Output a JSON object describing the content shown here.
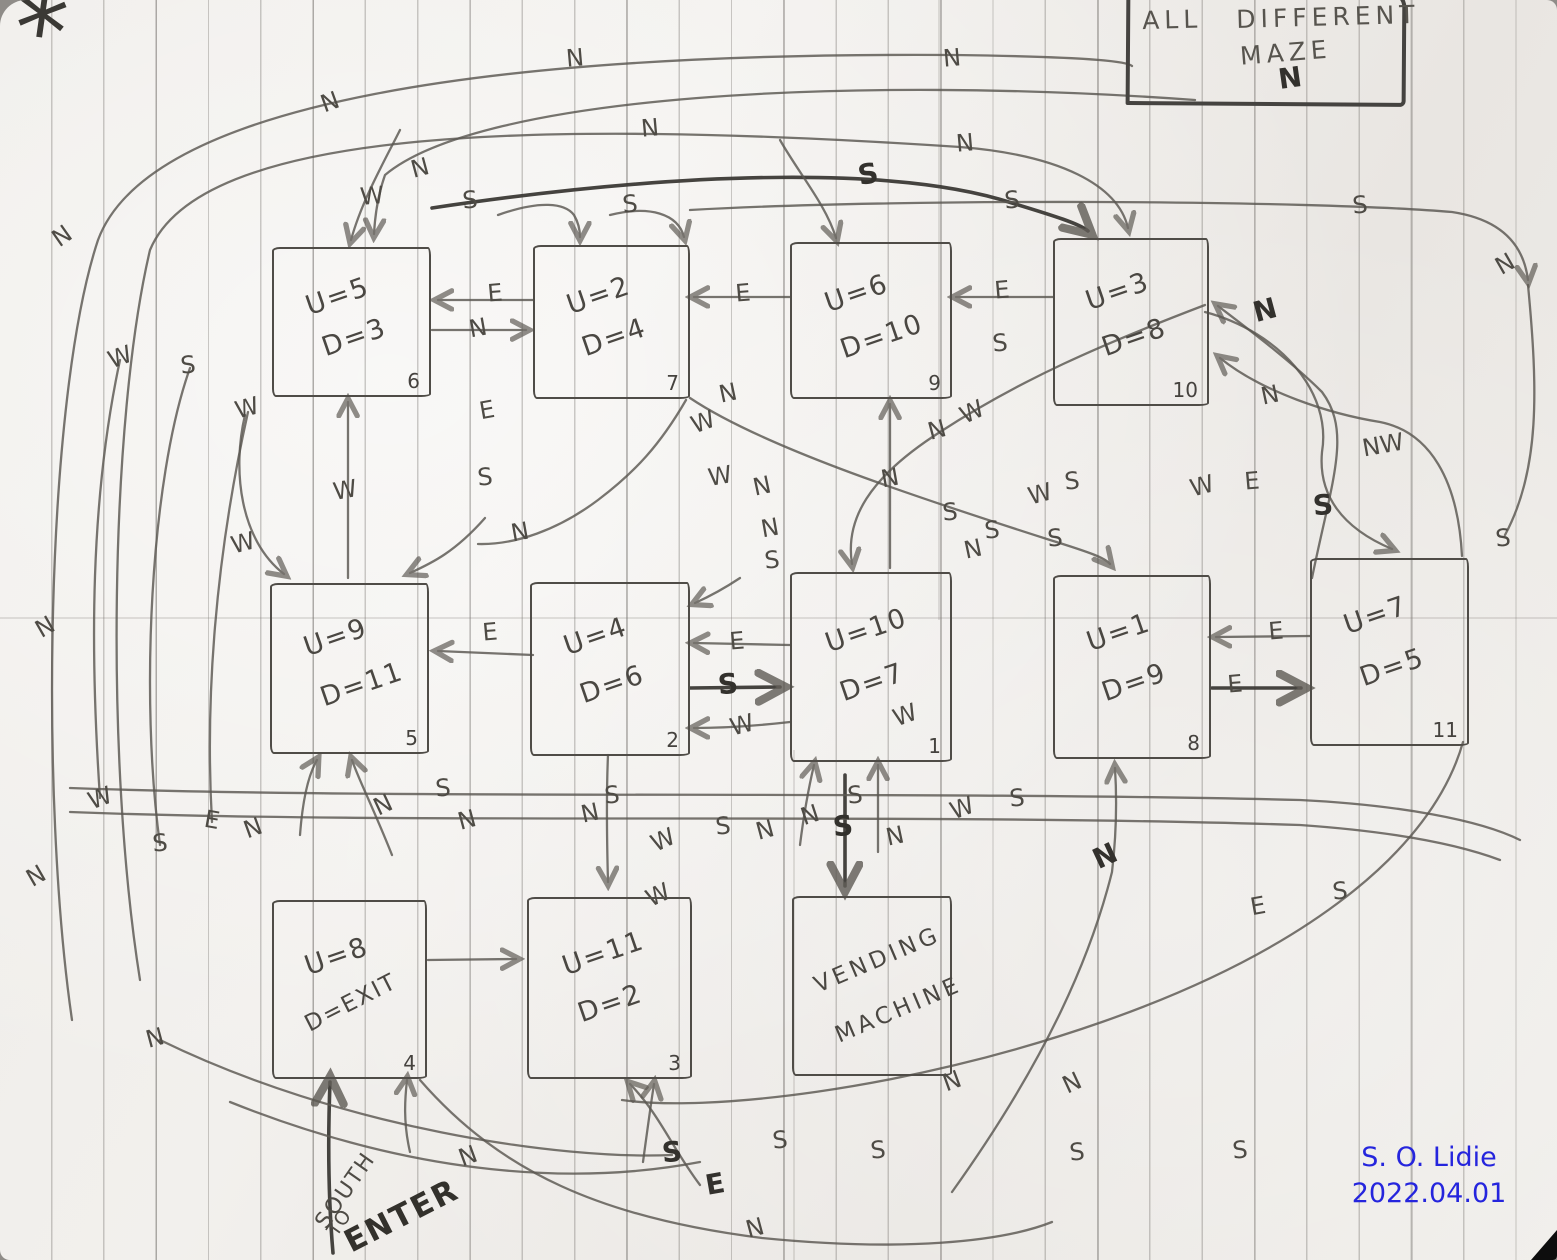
{
  "title_box": {
    "all": "ALL",
    "different": "DIFFERENT",
    "maze": "MAZE"
  },
  "annotations": {
    "asterisk": "*",
    "south": "SOUTH",
    "to": "TO",
    "enter": "ENTER",
    "signature_name": "S. O. Lidie",
    "signature_date": "2022.04.01",
    "signature_color": "#2525dd",
    "pencil_color": "#4e4b45",
    "ink_color": "#33312d"
  },
  "rooms": [
    {
      "name": "room-6",
      "u": "U=5",
      "d": "D=3",
      "number": "6",
      "x": 272,
      "y": 247,
      "w": 155,
      "h": 146
    },
    {
      "name": "room-7",
      "u": "U=2",
      "d": "D=4",
      "number": "7",
      "x": 533,
      "y": 245,
      "w": 153,
      "h": 150
    },
    {
      "name": "room-9",
      "u": "U=6",
      "d": "D=10",
      "number": "9",
      "x": 790,
      "y": 242,
      "w": 158,
      "h": 153
    },
    {
      "name": "room-10",
      "u": "U=3",
      "d": "D=8",
      "number": "10",
      "x": 1053,
      "y": 238,
      "w": 152,
      "h": 164
    },
    {
      "name": "room-5",
      "u": "U=9",
      "d": "D=11",
      "number": "5",
      "x": 270,
      "y": 583,
      "w": 155,
      "h": 167
    },
    {
      "name": "room-2",
      "u": "U=4",
      "d": "D=6",
      "number": "2",
      "x": 530,
      "y": 582,
      "w": 156,
      "h": 170
    },
    {
      "name": "room-1",
      "u": "U=10",
      "d": "D=7",
      "number": "1",
      "x": 790,
      "y": 572,
      "w": 158,
      "h": 186
    },
    {
      "name": "room-8",
      "u": "U=1",
      "d": "D=9",
      "number": "8",
      "x": 1053,
      "y": 575,
      "w": 154,
      "h": 180
    },
    {
      "name": "room-11",
      "u": "U=7",
      "d": "D=5",
      "number": "11",
      "x": 1310,
      "y": 558,
      "w": 155,
      "h": 184
    },
    {
      "name": "room-4",
      "u": "U=8",
      "d": "D=EXIT",
      "number": "4",
      "x": 272,
      "y": 900,
      "w": 151,
      "h": 175
    },
    {
      "name": "room-3",
      "u": "U=11",
      "d": "D=2",
      "number": "3",
      "x": 527,
      "y": 897,
      "w": 161,
      "h": 178
    },
    {
      "name": "vending-machine",
      "label1": "VENDING",
      "label2": "MACHINE",
      "x": 792,
      "y": 896,
      "w": 156,
      "h": 176
    }
  ],
  "direction_labels": [
    {
      "t": "N",
      "x": 575,
      "y": 58
    },
    {
      "t": "N",
      "x": 952,
      "y": 58
    },
    {
      "t": "N",
      "x": 1290,
      "y": 78,
      "b": 1,
      "r": -8
    },
    {
      "t": "N",
      "x": 330,
      "y": 102,
      "r": -20
    },
    {
      "t": "N",
      "x": 650,
      "y": 128
    },
    {
      "t": "N",
      "x": 965,
      "y": 143
    },
    {
      "t": "N",
      "x": 1505,
      "y": 264,
      "r": -30
    },
    {
      "t": "W",
      "x": 372,
      "y": 196
    },
    {
      "t": "N",
      "x": 420,
      "y": 168,
      "r": -15
    },
    {
      "t": "S",
      "x": 470,
      "y": 200
    },
    {
      "t": "S",
      "x": 630,
      "y": 204
    },
    {
      "t": "S",
      "x": 868,
      "y": 174,
      "b": 1,
      "r": -10
    },
    {
      "t": "S",
      "x": 1012,
      "y": 200
    },
    {
      "t": "S",
      "x": 1360,
      "y": 205
    },
    {
      "t": "N",
      "x": 62,
      "y": 236,
      "r": -35
    },
    {
      "t": "W",
      "x": 120,
      "y": 357,
      "r": -20
    },
    {
      "t": "S",
      "x": 188,
      "y": 365
    },
    {
      "t": "W",
      "x": 247,
      "y": 408,
      "r": -15
    },
    {
      "t": "W",
      "x": 243,
      "y": 543,
      "r": -15
    },
    {
      "t": "N",
      "x": 45,
      "y": 627,
      "r": -30
    },
    {
      "t": "W",
      "x": 100,
      "y": 798,
      "r": -20
    },
    {
      "t": "S",
      "x": 160,
      "y": 843
    },
    {
      "t": "E",
      "x": 212,
      "y": 820,
      "r": 10
    },
    {
      "t": "N",
      "x": 253,
      "y": 828,
      "r": -20
    },
    {
      "t": "N",
      "x": 36,
      "y": 876,
      "r": -30
    },
    {
      "t": "N",
      "x": 155,
      "y": 1038,
      "r": -15
    },
    {
      "t": "E",
      "x": 495,
      "y": 293
    },
    {
      "t": "N",
      "x": 478,
      "y": 328,
      "r": -10
    },
    {
      "t": "E",
      "x": 743,
      "y": 293
    },
    {
      "t": "E",
      "x": 1002,
      "y": 290
    },
    {
      "t": "S",
      "x": 1000,
      "y": 343
    },
    {
      "t": "E",
      "x": 487,
      "y": 410,
      "r": -10
    },
    {
      "t": "S",
      "x": 485,
      "y": 477
    },
    {
      "t": "N",
      "x": 520,
      "y": 532,
      "r": -10
    },
    {
      "t": "W",
      "x": 345,
      "y": 490,
      "r": -10
    },
    {
      "t": "N",
      "x": 728,
      "y": 393,
      "r": -12
    },
    {
      "t": "W",
      "x": 703,
      "y": 422,
      "r": -20
    },
    {
      "t": "W",
      "x": 972,
      "y": 412,
      "r": -25
    },
    {
      "t": "N",
      "x": 937,
      "y": 430,
      "r": -15
    },
    {
      "t": "W",
      "x": 720,
      "y": 476,
      "r": -10
    },
    {
      "t": "N",
      "x": 762,
      "y": 486,
      "r": -12
    },
    {
      "t": "N",
      "x": 770,
      "y": 528,
      "r": -10
    },
    {
      "t": "S",
      "x": 772,
      "y": 560
    },
    {
      "t": "N",
      "x": 890,
      "y": 478,
      "r": -10
    },
    {
      "t": "S",
      "x": 950,
      "y": 512
    },
    {
      "t": "S",
      "x": 992,
      "y": 530
    },
    {
      "t": "N",
      "x": 973,
      "y": 549,
      "r": -12
    },
    {
      "t": "S",
      "x": 1055,
      "y": 538
    },
    {
      "t": "W",
      "x": 1040,
      "y": 494,
      "r": -15
    },
    {
      "t": "S",
      "x": 1072,
      "y": 481
    },
    {
      "t": "N",
      "x": 1265,
      "y": 310,
      "b": 1,
      "r": -15
    },
    {
      "t": "N",
      "x": 1270,
      "y": 395,
      "r": -12
    },
    {
      "t": "NW",
      "x": 1383,
      "y": 445,
      "r": -10
    },
    {
      "t": "W",
      "x": 1202,
      "y": 486,
      "r": -15
    },
    {
      "t": "E",
      "x": 1252,
      "y": 481
    },
    {
      "t": "S",
      "x": 1323,
      "y": 505,
      "b": 1
    },
    {
      "t": "S",
      "x": 1503,
      "y": 538
    },
    {
      "t": "E",
      "x": 490,
      "y": 632
    },
    {
      "t": "E",
      "x": 737,
      "y": 641
    },
    {
      "t": "S",
      "x": 728,
      "y": 684,
      "b": 1
    },
    {
      "t": "W",
      "x": 742,
      "y": 725,
      "r": -15
    },
    {
      "t": "E",
      "x": 1276,
      "y": 631
    },
    {
      "t": "E",
      "x": 1235,
      "y": 684
    },
    {
      "t": "W",
      "x": 905,
      "y": 715,
      "r": -20
    },
    {
      "t": "S",
      "x": 443,
      "y": 788
    },
    {
      "t": "N",
      "x": 383,
      "y": 805,
      "r": -25
    },
    {
      "t": "N",
      "x": 467,
      "y": 820,
      "r": -15
    },
    {
      "t": "S",
      "x": 612,
      "y": 795
    },
    {
      "t": "N",
      "x": 590,
      "y": 813,
      "r": -12
    },
    {
      "t": "W",
      "x": 663,
      "y": 840,
      "r": -25
    },
    {
      "t": "S",
      "x": 723,
      "y": 826
    },
    {
      "t": "N",
      "x": 765,
      "y": 830,
      "r": -15
    },
    {
      "t": "N",
      "x": 810,
      "y": 815,
      "r": -18
    },
    {
      "t": "S",
      "x": 855,
      "y": 795
    },
    {
      "t": "W",
      "x": 962,
      "y": 808,
      "r": -20
    },
    {
      "t": "S",
      "x": 1017,
      "y": 798
    },
    {
      "t": "S",
      "x": 843,
      "y": 826,
      "b": 1
    },
    {
      "t": "N",
      "x": 895,
      "y": 836,
      "r": -12
    },
    {
      "t": "W",
      "x": 658,
      "y": 895,
      "r": -25
    },
    {
      "t": "N",
      "x": 952,
      "y": 1081,
      "r": -20
    },
    {
      "t": "S",
      "x": 672,
      "y": 1152,
      "b": 1
    },
    {
      "t": "S",
      "x": 780,
      "y": 1140
    },
    {
      "t": "S",
      "x": 878,
      "y": 1150
    },
    {
      "t": "E",
      "x": 715,
      "y": 1184,
      "b": 1,
      "r": -10
    },
    {
      "t": "N",
      "x": 755,
      "y": 1228,
      "r": -15
    },
    {
      "t": "N",
      "x": 468,
      "y": 1156,
      "r": -20
    },
    {
      "t": "S",
      "x": 1077,
      "y": 1152
    },
    {
      "t": "S",
      "x": 1240,
      "y": 1150
    },
    {
      "t": "N",
      "x": 1105,
      "y": 856,
      "b": 1,
      "r": -25
    },
    {
      "t": "E",
      "x": 1258,
      "y": 906,
      "r": -10
    },
    {
      "t": "S",
      "x": 1340,
      "y": 891
    },
    {
      "t": "N",
      "x": 1072,
      "y": 1083,
      "r": -25
    }
  ]
}
